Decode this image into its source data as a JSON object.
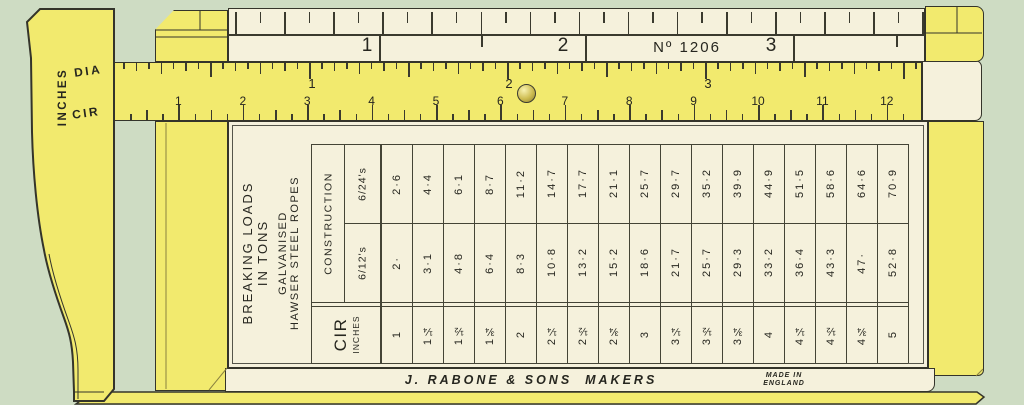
{
  "palette": {
    "background": "#cedcc3",
    "wood_yellow": "#f2ea6e",
    "wood_cream": "#f5f1dc",
    "line_dark": "#34342a"
  },
  "jaw": {
    "side_label": "INCHES",
    "dia_label": "DIA",
    "cir_label": "CIR"
  },
  "slider": {
    "scale_numbers": [
      "1",
      "2",
      "3"
    ],
    "model_label": "Nº 1206"
  },
  "ruler": {
    "dia_numbers": [
      "1",
      "2",
      "3"
    ],
    "cir_numbers": [
      "1",
      "2",
      "3",
      "4",
      "5",
      "6",
      "7",
      "8",
      "9",
      "10",
      "11",
      "12"
    ]
  },
  "table": {
    "title_lines": [
      "BREAKING LOADS",
      "IN TONS"
    ],
    "subtitle_lines": [
      "GALVANISED",
      "HAWSER STEEL ROPES"
    ],
    "construction_label": "CONSTRUCTION",
    "row_top_label": "6/24's",
    "row_mid_label": "6/12's",
    "cir_label": "CIR",
    "cir_unit_label": "INCHES",
    "columns": [
      {
        "cir": "1",
        "c612": "2·",
        "c624": "2·6"
      },
      {
        "cir": "1¼",
        "c612": "3·1",
        "c624": "4·4"
      },
      {
        "cir": "1½",
        "c612": "4·8",
        "c624": "6·1"
      },
      {
        "cir": "1¾",
        "c612": "6·4",
        "c624": "8·7"
      },
      {
        "cir": "2",
        "c612": "8·3",
        "c624": "11·2"
      },
      {
        "cir": "2¼",
        "c612": "10·8",
        "c624": "14·7"
      },
      {
        "cir": "2½",
        "c612": "13·2",
        "c624": "17·7"
      },
      {
        "cir": "2¾",
        "c612": "15·2",
        "c624": "21·1"
      },
      {
        "cir": "3",
        "c612": "18·6",
        "c624": "25·7"
      },
      {
        "cir": "3¼",
        "c612": "21·7",
        "c624": "29·7"
      },
      {
        "cir": "3½",
        "c612": "25·7",
        "c624": "35·2"
      },
      {
        "cir": "3¾",
        "c612": "29·3",
        "c624": "39·9"
      },
      {
        "cir": "4",
        "c612": "33·2",
        "c624": "44·9"
      },
      {
        "cir": "4¼",
        "c612": "36·4",
        "c624": "51·5"
      },
      {
        "cir": "4½",
        "c612": "43·3",
        "c624": "58·6"
      },
      {
        "cir": "4¾",
        "c612": "47·",
        "c624": "64·6"
      },
      {
        "cir": "5",
        "c612": "52·8",
        "c624": "70·9"
      }
    ]
  },
  "footer": {
    "maker_label": "J. RABONE & SONS  MAKERS",
    "made_in_lines": [
      "MADE IN",
      "ENGLAND"
    ]
  }
}
